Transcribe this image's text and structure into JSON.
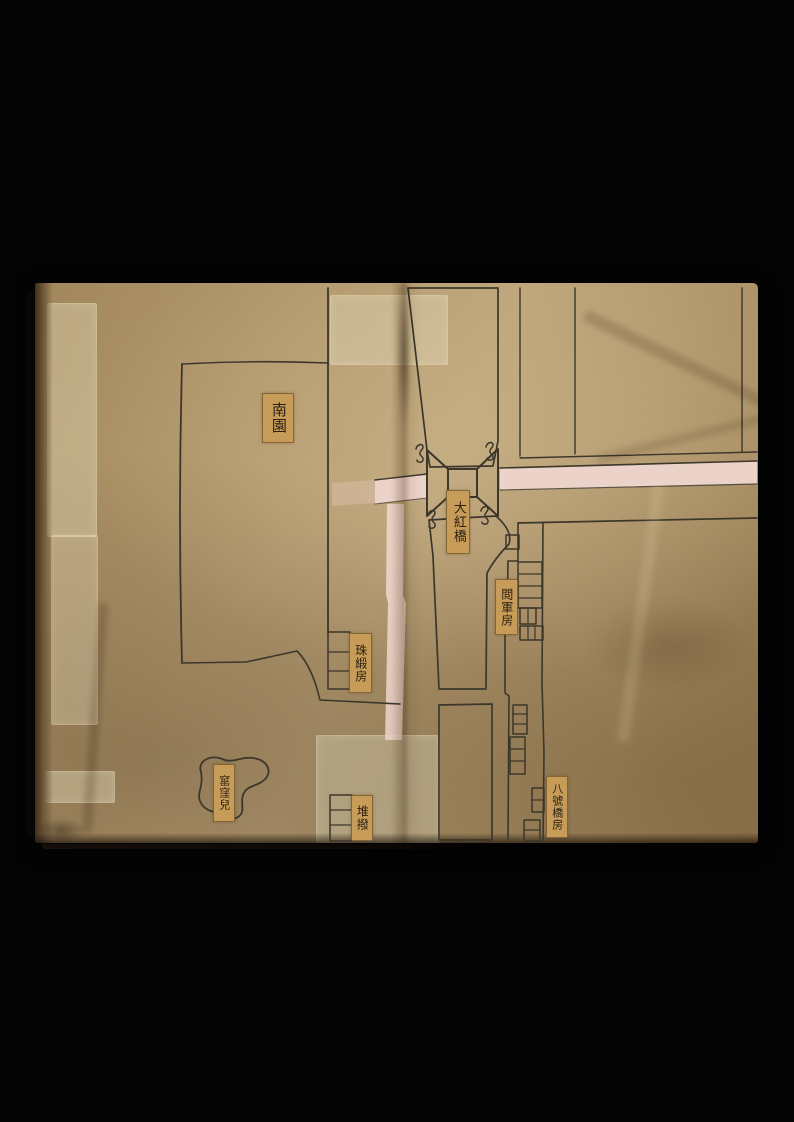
{
  "colors": {
    "bg": "#040404",
    "ink": "#3c372b",
    "canal": "#a2a56e",
    "road": "#ecd3c9",
    "pond": "#b9874f",
    "slip": "#c69c58",
    "slip-text": "#2b2012",
    "paper-bridge": "#b9a175"
  },
  "labels": {
    "south_garden": {
      "text": "南園"
    },
    "dahong_bridge": {
      "text": "大紅橋"
    },
    "review_house": {
      "text": "閲軍房"
    },
    "satin_house": {
      "text": "珠緞房"
    },
    "sentry_post": {
      "text": "堆撥"
    },
    "bridge8_house": {
      "text": "八號橋房"
    },
    "kiln_hollow": {
      "text": "窰窪兒"
    }
  }
}
